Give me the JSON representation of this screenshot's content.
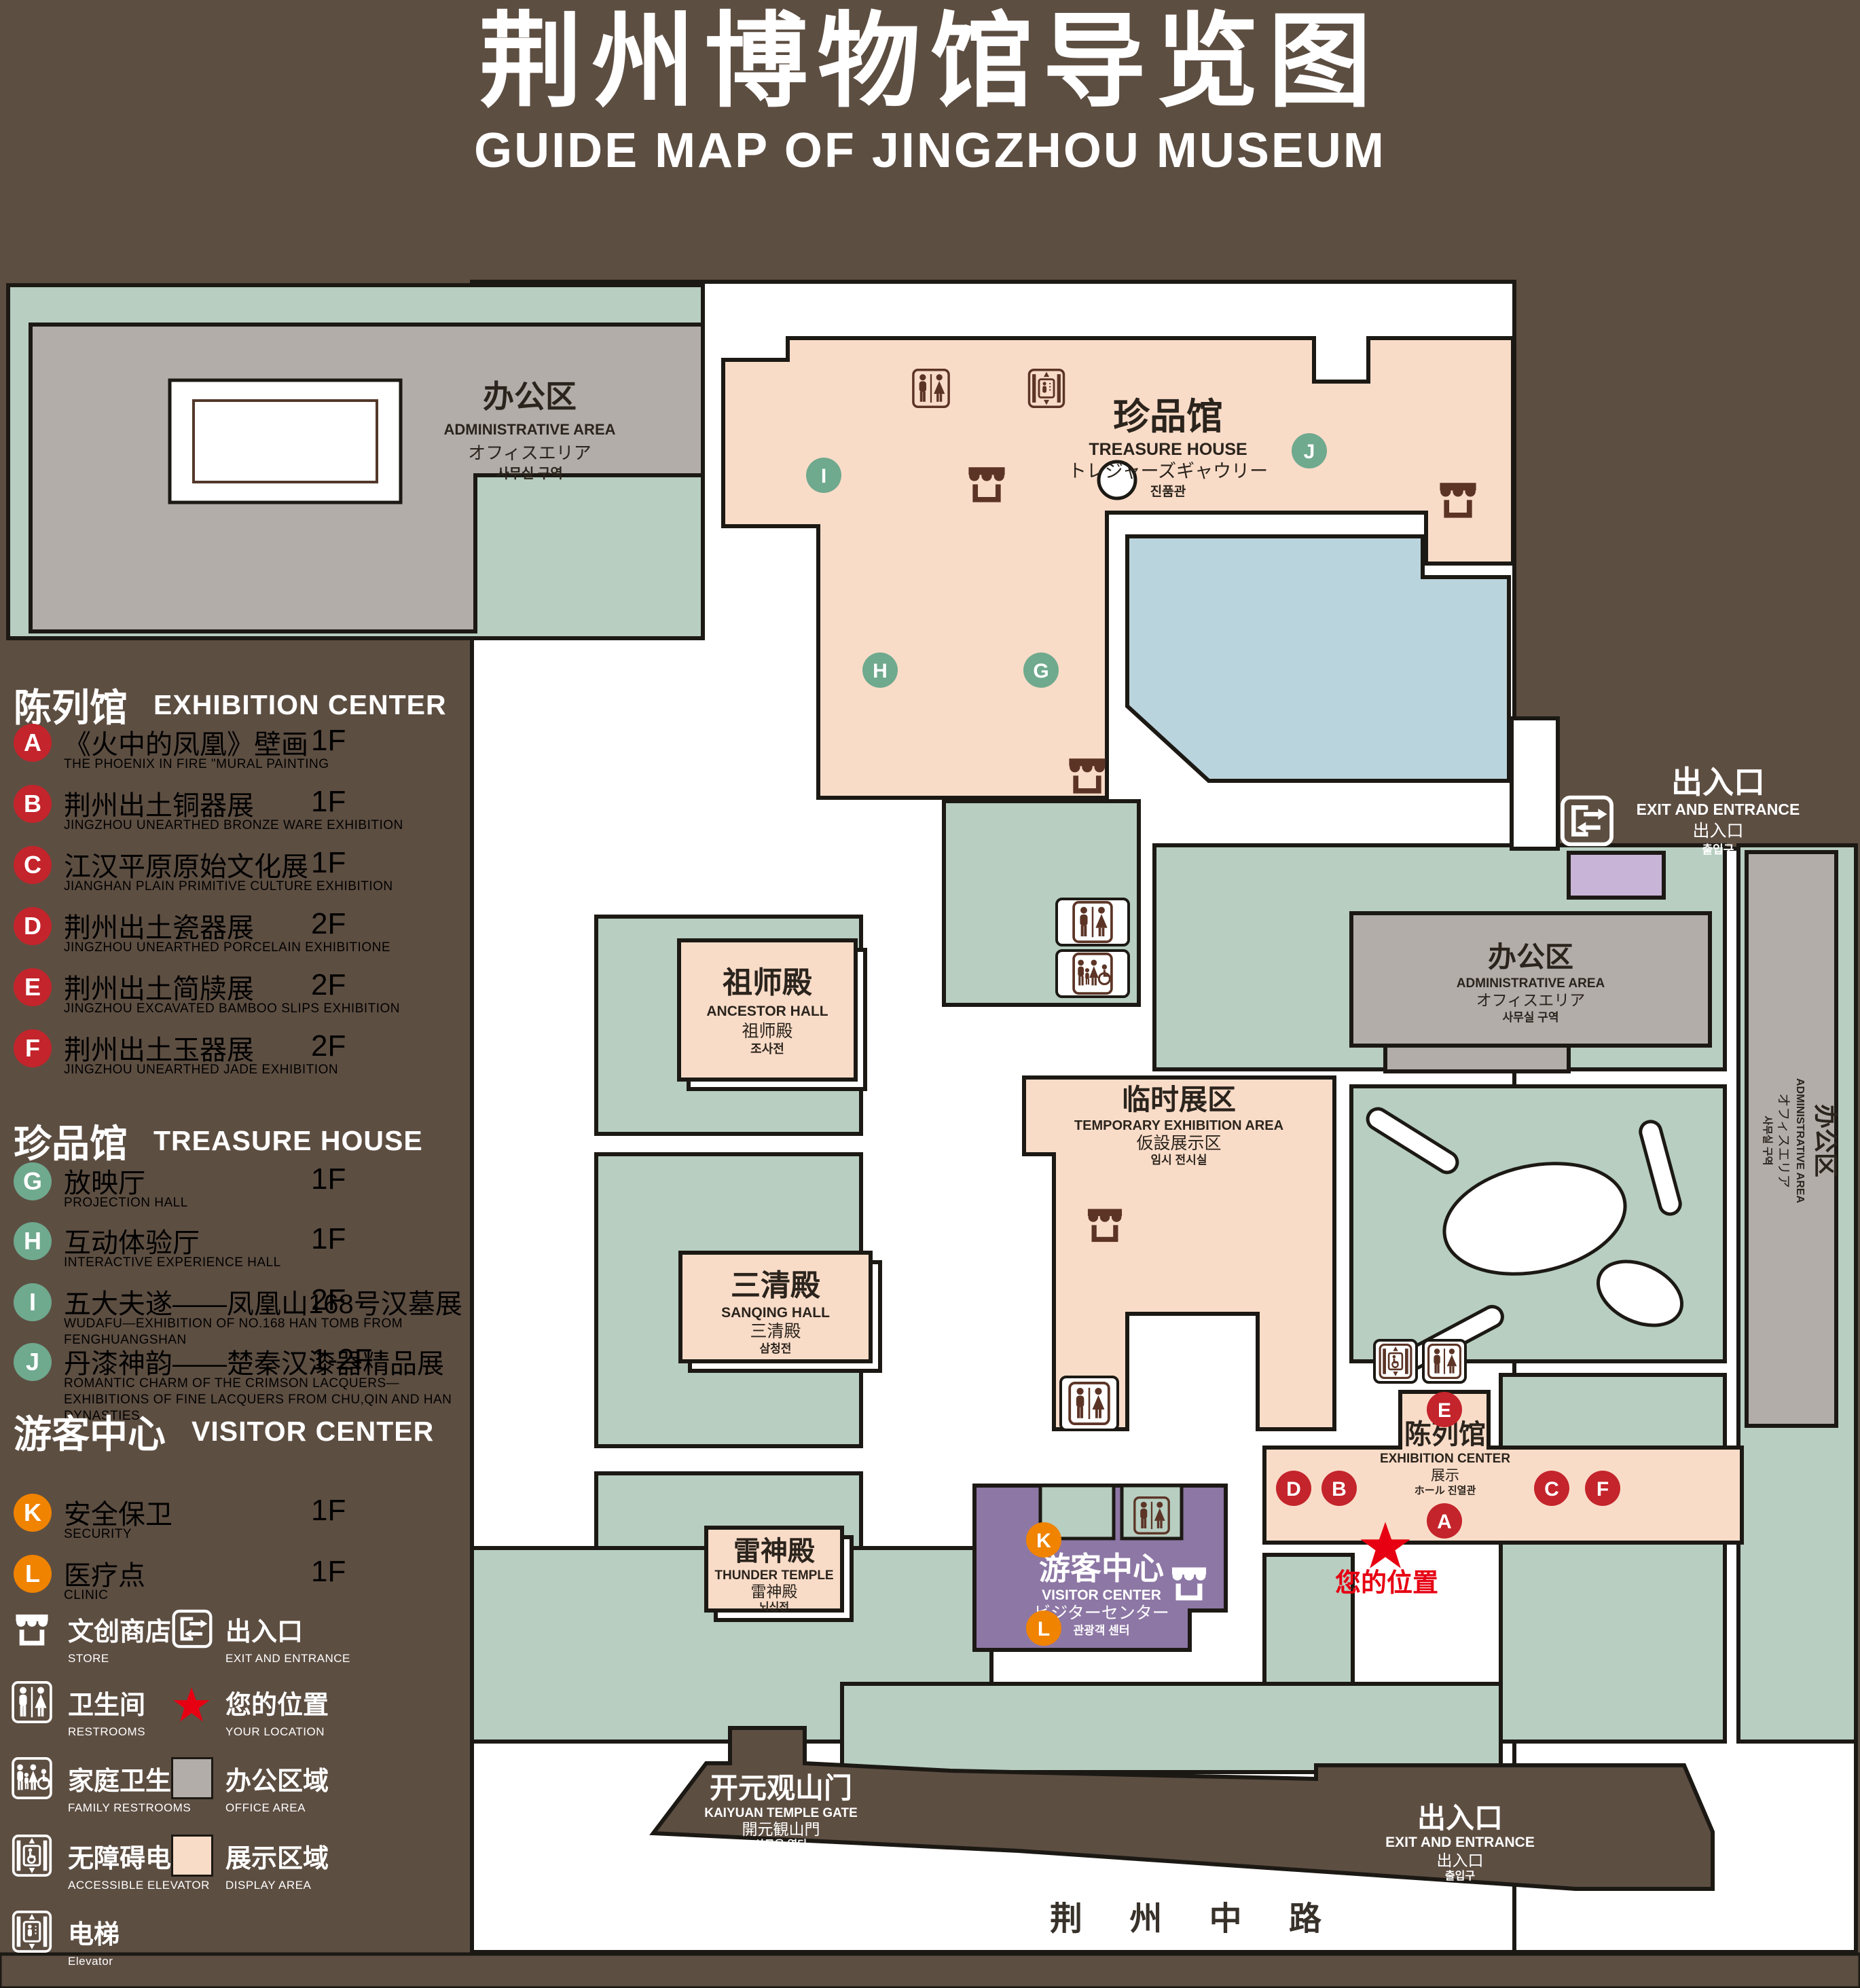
{
  "title": {
    "zh": "荆州博物馆导览图",
    "en": "GUIDE MAP OF JINGZHOU MUSEUM"
  },
  "legend": {
    "sections": [
      {
        "zh": "陈列馆",
        "en": "EXHIBITION CENTER",
        "items": [
          {
            "letter": "A",
            "zh": "《火中的凤凰》壁画",
            "en": "THE PHOENIX IN FIRE \"MURAL PAINTING",
            "floor": "1F"
          },
          {
            "letter": "B",
            "zh": "荆州出土铜器展",
            "en": "JINGZHOU UNEARTHED BRONZE WARE EXHIBITION",
            "floor": "1F"
          },
          {
            "letter": "C",
            "zh": "江汉平原原始文化展",
            "en": "JIANGHAN PLAIN PRIMITIVE CULTURE EXHIBITION",
            "floor": "1F"
          },
          {
            "letter": "D",
            "zh": "荆州出土瓷器展",
            "en": "JINGZHOU UNEARTHED PORCELAIN EXHIBITIONE",
            "floor": "2F"
          },
          {
            "letter": "E",
            "zh": "荆州出土简牍展",
            "en": "JINGZHOU EXCAVATED BAMBOO SLIPS EXHIBITION",
            "floor": "2F"
          },
          {
            "letter": "F",
            "zh": "荆州出土玉器展",
            "en": "JINGZHOU UNEARTHED JADE EXHIBITION",
            "floor": "2F"
          }
        ]
      },
      {
        "zh": "珍品馆",
        "en": "TREASURE HOUSE",
        "items": [
          {
            "letter": "G",
            "zh": "放映厅",
            "en": "PROJECTION HALL",
            "floor": "1F"
          },
          {
            "letter": "H",
            "zh": "互动体验厅",
            "en": "INTERACTIVE EXPERIENCE HALL",
            "floor": "1F"
          },
          {
            "letter": "I",
            "zh": "五大夫遂——凤凰山168号汉墓展",
            "en": "WUDAFU—EXHIBITION OF NO.168 HAN TOMB FROM FENGHUANGSHAN",
            "floor": "2F"
          },
          {
            "letter": "J",
            "zh": "丹漆神韵——楚秦汉漆器精品展",
            "en": "ROMANTIC CHARM OF THE CRIMSON LACQUERS—EXHIBITIONS OF FINE LACQUERS FROM CHU,QIN AND HAN DYNASTIES",
            "floor": "1-2F"
          }
        ]
      },
      {
        "zh": "游客中心",
        "en": "VISITOR CENTER",
        "items": [
          {
            "letter": "K",
            "zh": "安全保卫",
            "en": "SECURITY",
            "floor": "1F"
          },
          {
            "letter": "L",
            "zh": "医疗点",
            "en": "CLINIC",
            "floor": "1F"
          }
        ]
      }
    ],
    "symbols": [
      {
        "id": "store",
        "zh": "文创商店",
        "en": "STORE"
      },
      {
        "id": "exit",
        "zh": "出入口",
        "en": "EXIT AND ENTRANCE"
      },
      {
        "id": "restroom",
        "zh": "卫生间",
        "en": "RESTROOMS"
      },
      {
        "id": "your-location",
        "zh": "您的位置",
        "en": "YOUR LOCATION"
      },
      {
        "id": "family-restroom",
        "zh": "家庭卫生间",
        "en": "FAMILY RESTROOMS"
      },
      {
        "id": "office-area",
        "zh": "办公区域",
        "en": "OFFICE AREA"
      },
      {
        "id": "accessible-elevator",
        "zh": "无障碍电梯",
        "en": "ACCESSIBLE ELEVATOR"
      },
      {
        "id": "display-area",
        "zh": "展示区域",
        "en": "DISPLAY AREA"
      },
      {
        "id": "elevator",
        "zh": "电梯",
        "en": "Elevator"
      }
    ]
  },
  "map": {
    "buildings": {
      "admin_nw": {
        "zh": "办公区",
        "en": "ADMINISTRATIVE AREA",
        "ja": "オフィスエリア",
        "ko": "사무실 구역"
      },
      "treasure_house": {
        "zh": "珍品馆",
        "en": "TREASURE HOUSE",
        "ja": "トレジャーズギャウリー",
        "ko": "진품관"
      },
      "ancestor_hall": {
        "zh": "祖师殿",
        "en": "ANCESTOR HALL",
        "ja": "祖师殿",
        "ko": "조사전"
      },
      "temporary_area": {
        "zh": "临时展区",
        "en": "TEMPORARY EXHIBITION AREA",
        "ja": "仮設展示区",
        "ko": "임시 전시실"
      },
      "admin_right": {
        "zh": "办公区",
        "en": "ADMINISTRATIVE AREA",
        "ja": "オフィスエリア",
        "ko": "사무실 구역"
      },
      "admin_east": {
        "zh": "办公区",
        "en": "ADMINISTRATIVE AREA",
        "ja": "オフィスエリア",
        "ko": "사무실 구역"
      },
      "sanqing_hall": {
        "zh": "三清殿",
        "en": "SANQING HALL",
        "ja": "三清殿",
        "ko": "삼청전"
      },
      "thunder_temple": {
        "zh": "雷神殿",
        "en": "THUNDER TEMPLE",
        "ja": "雷神殿",
        "ko": "뇌신전"
      },
      "visitor_center": {
        "zh": "游客中心",
        "en": "VISITOR CENTER",
        "ja": "ビジターセンター",
        "ko": "관광객 센터"
      },
      "exhibition_center": {
        "zh": "陈列馆",
        "en": "EXHIBITION CENTER",
        "ja": "展示",
        "ko": "ホール 진열관"
      },
      "gate": {
        "zh": "开元观山门",
        "en": "KAIYUAN TEMPLE GATE",
        "ja": "開元観山門",
        "ko": "산문을 열다"
      },
      "exit_ne": {
        "zh": "出入口",
        "en": "EXIT AND ENTRANCE",
        "ja": "出入口",
        "ko": "출입구"
      },
      "exit_s": {
        "zh": "出入口",
        "en": "EXIT AND ENTRANCE",
        "ja": "出入口",
        "ko": "출입구"
      },
      "road": {
        "zh": "荆 州 中 路"
      },
      "your_location": {
        "zh": "您的位置"
      }
    },
    "markers": {
      "a": "A",
      "b": "B",
      "c": "C",
      "d": "D",
      "e": "E",
      "f": "F",
      "g": "G",
      "h": "H",
      "i": "I",
      "j": "J",
      "k": "K",
      "l": "L"
    }
  },
  "colors": {
    "background": "#5d4e42",
    "campus_green": "#b7cec1",
    "office_gray": "#b3adaa",
    "display_pink": "#f9dcc8",
    "pond_blue": "#bad4dd",
    "visitor_purple": "#8d77a5",
    "lavender": "#c7b4d6",
    "marker_red": "#c4242b",
    "marker_green": "#6fa98e",
    "marker_orange": "#f08300",
    "star_red": "#e60012",
    "icon_brown": "#5c3426",
    "outline": "#1c1914"
  }
}
